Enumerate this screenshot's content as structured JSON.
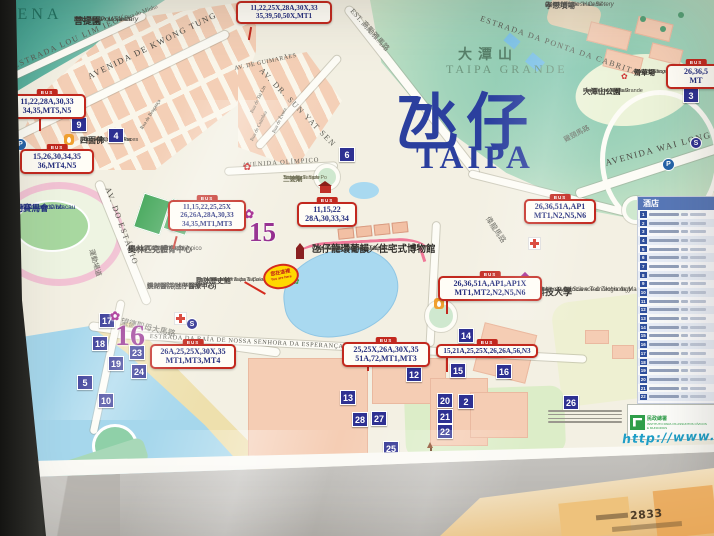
{
  "map": {
    "title": {
      "cn": "氹仔",
      "en": "TAIPA"
    },
    "region": {
      "cn": "大潭山",
      "en": "TAIPA GRANDE"
    },
    "corner_text": "UENA",
    "bus_tag": "BUS",
    "icons": {
      "lotus": "✿",
      "flower": "✿",
      "parking": "P",
      "dollar": "S"
    },
    "bus_stops": [
      {
        "l1": "11,22,28A,30,33",
        "l2": "34,35,MT5,N5"
      },
      {
        "l1": "15,26,30,34,35",
        "l2": "36,MT4,N5"
      },
      {
        "l1": "11,22,25X,28A,30X,33",
        "l2": "35,39,50,50X,MT1"
      },
      {
        "l1": "11,15,22,25,25X",
        "l2": "26,26A,28A,30,33",
        "l3": "34,35,MT1,MT3"
      },
      {
        "l1": "11,15,22",
        "l2": "28A,30,33,34"
      },
      {
        "l1": "26,36,51A,AP1",
        "l2": "MT1,N2,N5,N6"
      },
      {
        "l1": "26,36,51A,AP1,AP1X",
        "l2": "MT1,MT2,N2,N5,N6"
      },
      {
        "l1": "26A,25,25X,30X,35",
        "l2": "MT1,MT3,MT4"
      },
      {
        "l1": "25,25X,26A,30X,35",
        "l2": "51A,72,MT1,MT3"
      },
      {
        "l1": "15,21A,25,25X,26,26A,56,N3"
      },
      {
        "l1": "26,36,5",
        "l2": "MT"
      }
    ],
    "markers": [
      "9",
      "4",
      "6",
      "3",
      "17",
      "18",
      "23",
      "19",
      "24",
      "5",
      "10",
      "12",
      "13",
      "28",
      "27",
      "25",
      "14",
      "15",
      "16",
      "20",
      "2",
      "21",
      "22",
      "26"
    ],
    "purple_markers": [
      "15",
      "16"
    ],
    "places": {
      "pou_tai": {
        "cn": "菩提園",
        "pt": "Mosteiro Pou Tai Un",
        "en": "Pou Tai Un Monastery"
      },
      "buddha": {
        "cn": "四面佛",
        "pt": "Buda de Quatro Faces",
        "en": "Four-Faced Buddha"
      },
      "jockey": {
        "cn": "澳門賽馬會",
        "pt": "Jockey Clube de Macau",
        "en": "Macau Jockey Club"
      },
      "olympic": {
        "cn": "奧林匹克體育中心",
        "pt": "Centro Desportivo Olímpico",
        "en": "Olympic Sports Centre"
      },
      "hospital": {
        "cn": "鏡湖醫院(氹仔醫療中心)",
        "en": "KIANG WU HOSPITAL",
        "en2": "(TAIPA CLINIC)"
      },
      "sam_po": {
        "cn": "三婆廟",
        "pt": "Templo de Sam Po",
        "en": "Sam Po Temple"
      },
      "houses_museum": {
        "cn": "氹仔龍環葡韻／住宅式博物館",
        "pt": "Casas-Museus da Taipa",
        "en": "The Taipa Houses-Museum"
      },
      "history_museum": {
        "cn": "路氹歷史館",
        "pt": "Museu da História da Taipa e Coloane",
        "en": "The Museum of Taipa & Coloane History"
      },
      "must": {
        "cn": "澳門科技大學",
        "pt": "Universidade de Ciência e Tecnologia de Macau",
        "en": "Macau University of Science & Technology"
      },
      "cemetery": {
        "cn": "孝思墳場",
        "pt": "Cemitério de \"Hau Si\"",
        "en": "United Chinese Cemetery"
      },
      "grass_slide": {
        "cn": "滑草場",
        "pt": "Área de Escorrega",
        "en": "Grass Sliding Area"
      },
      "grande_park": {
        "cn": "大潭山公園",
        "pt": "Parque de Taipa Grande",
        "en": "Taipa Grande Park"
      }
    },
    "roads": {
      "lou_lim_ieok": "ESTRADA LOU LIM IEOK",
      "rua_minho": "Rua do Minho",
      "kwong_tung": "AVENIDA DE KWONG TUNG",
      "sun_yat_sen": "AV. DR. SUN YAT SEN",
      "guimaraes": "AV. DE GUIMARÃES",
      "albano": "EST. 高勵雅馬路",
      "olimpico": "AVENIDA OLÍMPICO",
      "estadio": "AV. DO ESTÁDIO",
      "estadio_cn": "運動場道",
      "mong_tak": "望德聖母大馬路",
      "esperanca": "ESTRADA DA BAÍA DE NOSSA SENHORA DA ESPERANÇA",
      "cabrita": "ESTRADA DA PONTA DA CABRITA",
      "wai_long": "AVENIDA WAI LONG",
      "kai_keng": "雞頸馬路",
      "wai_long_cn": "偉龍馬路",
      "tai_lin": "Rua de Tai Lin",
      "evora": "Rua de Évora",
      "coimbra": "Rua de Coimbra",
      "braganca": "Rua de Bragança"
    },
    "you_are_here": {
      "cn": "您在這裡",
      "en": "You are here"
    },
    "legend": {
      "header": "酒店",
      "rows": [
        "1",
        "2",
        "3",
        "4",
        "5",
        "6",
        "7",
        "8",
        "9",
        "10",
        "11",
        "12",
        "13",
        "14",
        "15",
        "16",
        "17",
        "18",
        "19",
        "20",
        "21",
        "22"
      ]
    },
    "footer": {
      "iacm_cn": "民政總署",
      "iacm_pt": "INSTITUTO PARA OS ASSUNTOS CÍVICOS E MUNICIPAIS",
      "url": "http://www.iacm",
      "phone": "2833"
    }
  }
}
